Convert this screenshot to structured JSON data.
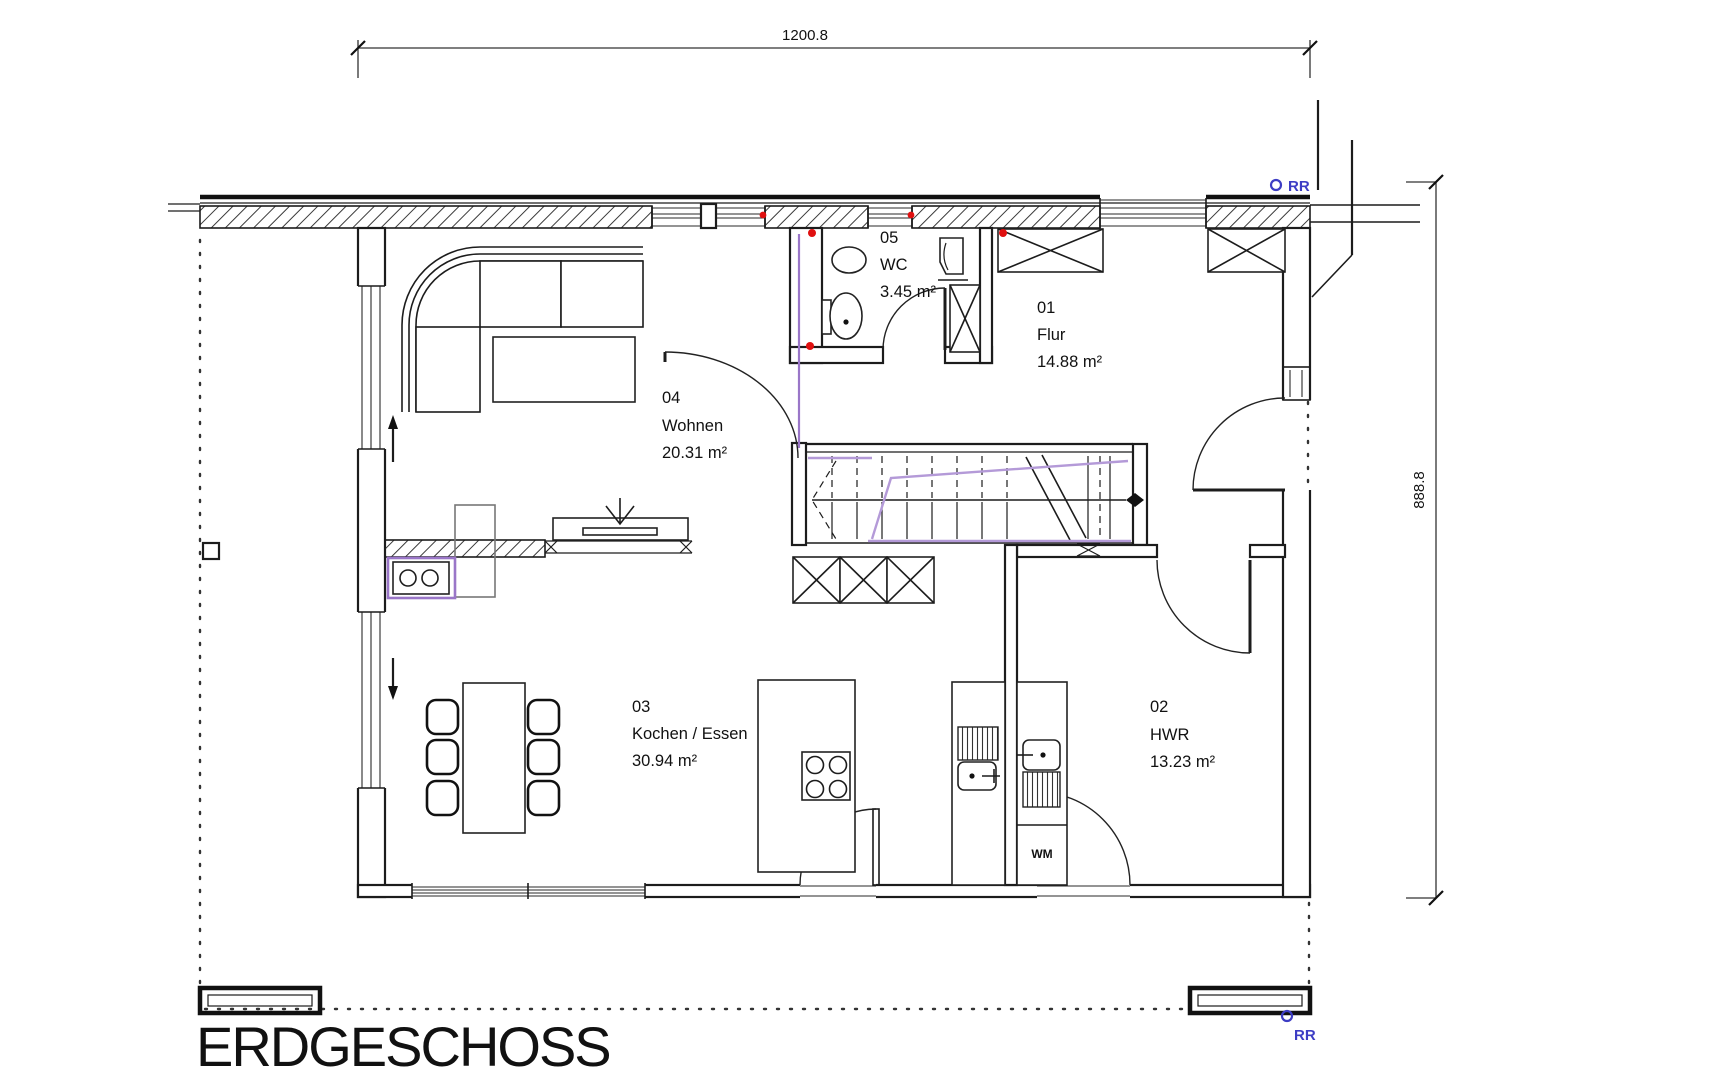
{
  "drawing": {
    "title": "ERDGESCHOSS",
    "dimensions": {
      "top": "1200.8",
      "right": "888.8"
    },
    "rooms": {
      "flur": {
        "number": "01",
        "name": "Flur",
        "area": "14.88  m²"
      },
      "hwr": {
        "number": "02",
        "name": "HWR",
        "area": "13.23  m²"
      },
      "kochen": {
        "number": "03",
        "name": "Kochen / Essen",
        "area": "30.94  m²"
      },
      "wohnen": {
        "number": "04",
        "name": "Wohnen",
        "area": "20.31  m²"
      },
      "wc": {
        "number": "05",
        "name": "WC",
        "area": "3.45  m²"
      }
    },
    "labels": {
      "washing_machine": "WM",
      "downpipe": "RR"
    },
    "colors": {
      "wall": "#1c1c1c",
      "installation_purple": "#9a76c8",
      "walkline_purple": "#b49ad8",
      "marker_blue": "#3d3dc4",
      "marker_red": "#e01010",
      "dimension": "#333333"
    }
  }
}
